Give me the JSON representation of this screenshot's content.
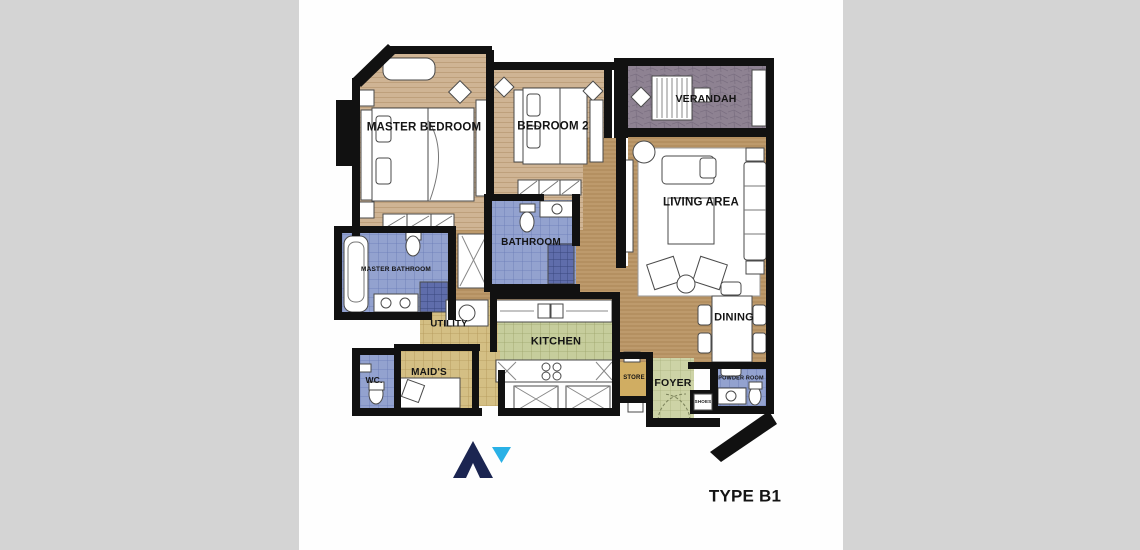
{
  "caption": "TYPE B1",
  "rooms": {
    "master_bedroom": "MASTER BEDROOM",
    "bedroom_2": "BEDROOM 2",
    "verandah": "VERANDAH",
    "living_area": "LIVING AREA",
    "bathroom": "BATHROOM",
    "master_bathroom": "MASTER BATHROOM",
    "utility": "UTILITY",
    "kitchen": "KITCHEN",
    "dining": "DINING",
    "wc": "WC.",
    "maids": "MAID'S",
    "store": "STORE",
    "foyer": "FOYER",
    "powder_room": "POWDER ROOM",
    "shoes": "SHOES"
  },
  "logo": {
    "mark": "mountain-A-with-blue-triangle",
    "primary_color": "#1b2551",
    "accent_color": "#2ab1e6"
  },
  "palette": {
    "background_gray": "#d4d4d4",
    "paper_white": "#fefefe",
    "wall_black": "#111111",
    "wood_main": "#bd9a6c",
    "wood_bedroom": "#cfb494",
    "bathroom_blue": "#93a2cf",
    "shower_blue": "#5f6dab",
    "kitchen_green": "#c6cd9c",
    "foyer_green": "#cdd3a6",
    "utility_khaki": "#d4bf84",
    "store_tan": "#d0ad62",
    "verandah_gray": "#8e8292"
  }
}
